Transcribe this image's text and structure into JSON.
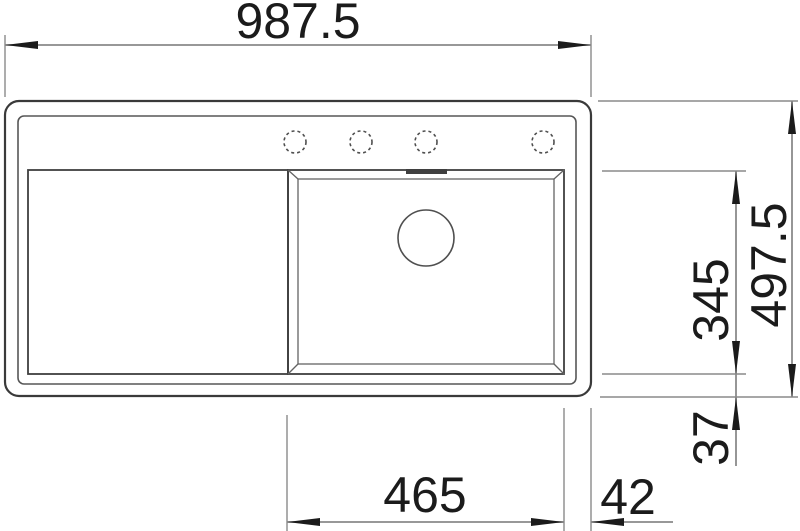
{
  "drawing": {
    "kind": "sink-plan-view-technical-drawing",
    "colors": {
      "background": "#ffffff",
      "outline": "#3a3a3a",
      "dimension_line": "#8a8a8a",
      "text": "#1b1b1b"
    },
    "features": {
      "tap_hole_count": 4,
      "has_drainboard": true,
      "has_drain_circle": true,
      "has_overflow_slot": true
    },
    "dimensions": {
      "overall_width": "987.5",
      "overall_depth": "497.5",
      "bowl_depth": "345",
      "front_ledge": "37",
      "bowl_width": "465",
      "right_ledge": "42"
    }
  }
}
